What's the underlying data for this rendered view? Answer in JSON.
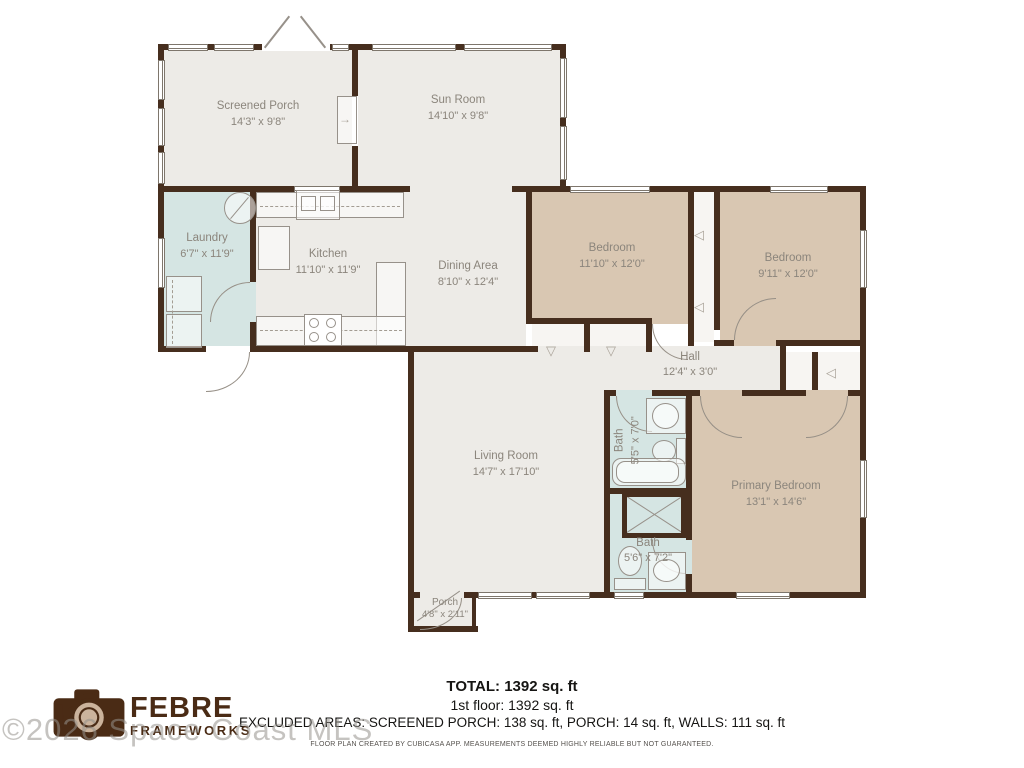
{
  "watermark": "©2026 Space Coast MLS",
  "logo": {
    "line1": "FEBRE",
    "line2": "FRAMEWORKS"
  },
  "rooms": [
    {
      "name": "Screened Porch",
      "dims": "14'3\" x 9'8\""
    },
    {
      "name": "Sun Room",
      "dims": "14'10\" x 9'8\""
    },
    {
      "name": "Laundry",
      "dims": "6'7\" x 11'9\""
    },
    {
      "name": "Kitchen",
      "dims": "11'10\" x 11'9\""
    },
    {
      "name": "Dining Area",
      "dims": "8'10\" x 12'4\""
    },
    {
      "name": "Bedroom",
      "dims": "11'10\" x 12'0\""
    },
    {
      "name": "Bedroom",
      "dims": "9'11\" x 12'0\""
    },
    {
      "name": "Hall",
      "dims": "12'4\" x 3'0\""
    },
    {
      "name": "Bath",
      "dims": "5'5\" x 7'0\""
    },
    {
      "name": "Living Room",
      "dims": "14'7\" x 17'10\""
    },
    {
      "name": "Bath",
      "dims": "5'6\" x 7'2\""
    },
    {
      "name": "Primary Bedroom",
      "dims": "13'1\" x 14'6\""
    },
    {
      "name": "Porch",
      "dims": "4'8\" x 2'11\""
    }
  ],
  "summary": {
    "total": "TOTAL: 1392 sq. ft",
    "floor1": "1st floor: 1392 sq. ft",
    "excluded": "EXCLUDED AREAS: SCREENED PORCH: 138 sq. ft, PORCH: 14 sq. ft, WALLS: 111 sq. ft",
    "disclaimer": "FLOOR PLAN CREATED BY CUBICASA APP. MEASUREMENTS DEEMED HIGHLY RELIABLE BUT NOT GUARANTEED."
  },
  "colors": {
    "wall": "#46), 2e1e",
    "wall_brown": "#462e1e",
    "room_gray": "#edebe7",
    "bedroom_tan": "#d9c7b2",
    "wet_room_blue": "#d5e5e3",
    "label_gray": "#8b857c",
    "logo_brown": "#4a2b15"
  }
}
